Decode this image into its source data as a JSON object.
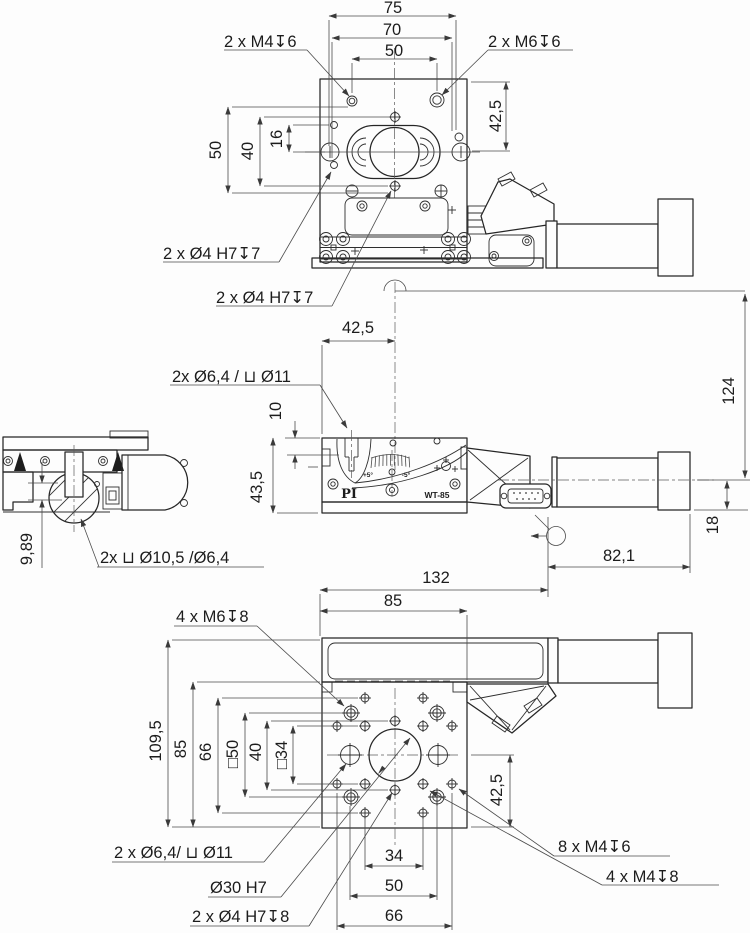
{
  "drawing": {
    "type": "technical-dimension-drawing",
    "views": {
      "top": {
        "callout_m4": "2 x M4↧6",
        "callout_m6": "2 x M6↧6",
        "callout_h7_upper": "2 x Ø4 H7↧7",
        "callout_h7_lower": "2 x Ø4 H7↧7",
        "dim_width_outer": "75",
        "dim_width_mid": "70",
        "dim_width_inner": "50",
        "dim_right": "42,5",
        "dim_left_outer": "50",
        "dim_left_mid": "40",
        "dim_left_inner": "16"
      },
      "side": {
        "dim_offset": "42,5",
        "callout_cbore": "2x Ø6,4 / ⊔ Ø11",
        "dim_depth": "10",
        "dim_height": "43,5",
        "dim_total_height": "124",
        "dim_axis_height": "18",
        "scale_plus": "+5°",
        "scale_minus": "-5°",
        "brand": "PI",
        "model": "WT-85"
      },
      "rear": {
        "dim_offset": "9,89",
        "callout_cbore": "2x ⊔ Ø10,5 /Ø6,4"
      },
      "bottom": {
        "dim_motor_length": "82,1",
        "dim_width_total": "132",
        "dim_width_plate": "85",
        "dim_height_total": "109,5",
        "dim_height_plate": "85",
        "dim_v66": "66",
        "dim_v50": "□50",
        "dim_v40": "40",
        "dim_v34": "□34",
        "dim_right": "42,5",
        "dim_b34": "34",
        "dim_b50": "50",
        "dim_b66": "66",
        "callout_m6": "4 x M6↧8",
        "callout_cbore": "2 x Ø6,4/ ⊔ Ø11",
        "callout_bore": "Ø30 H7",
        "callout_h7": "2 x Ø4 H7↧8",
        "callout_m4_8x": "8 x M4↧6",
        "callout_m4_4x": "4 x M4↧8"
      }
    }
  }
}
